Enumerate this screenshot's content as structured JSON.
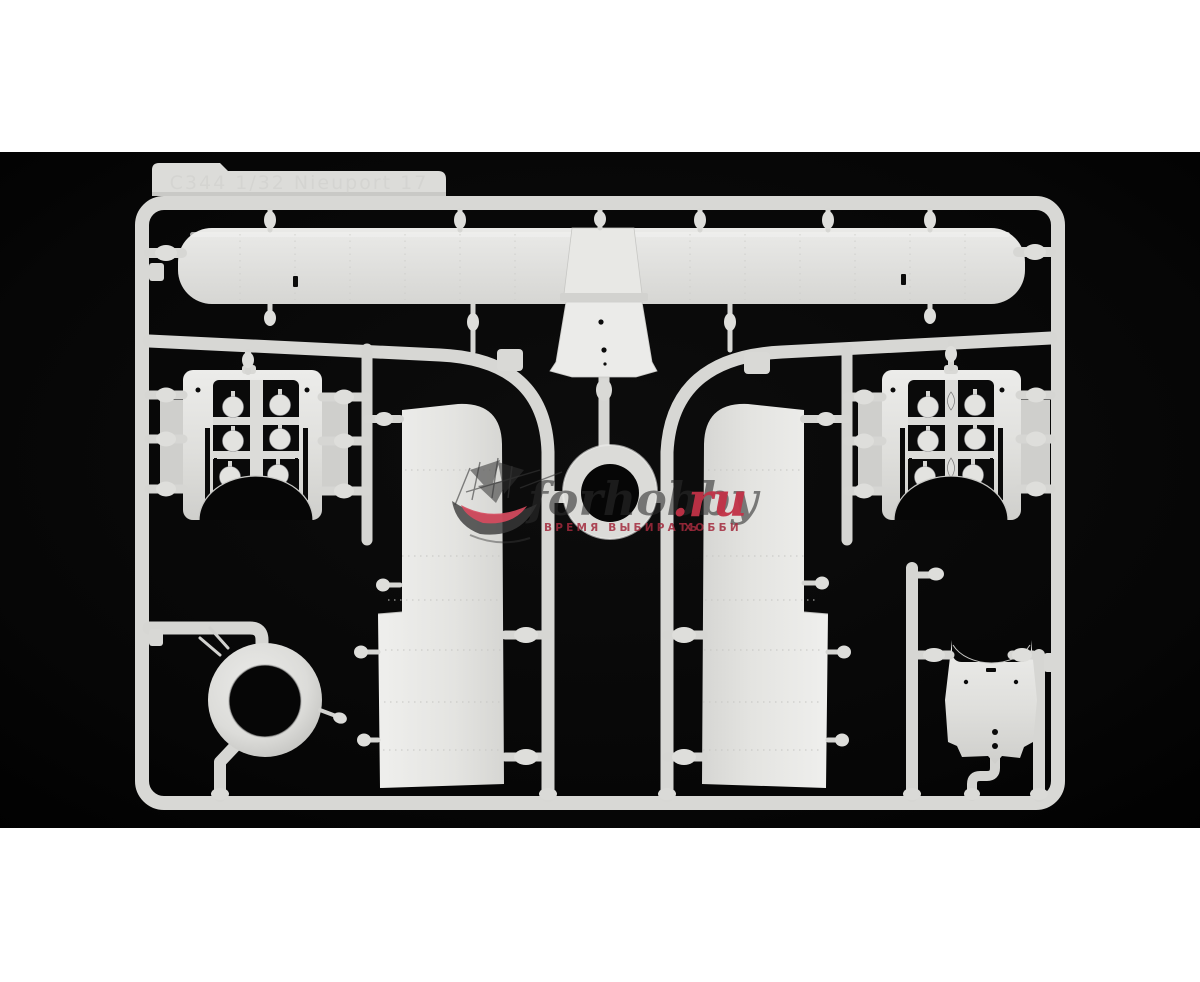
{
  "photo": {
    "type": "product-photo",
    "subject": "injection-molded aircraft model kit sprue in light gray styrene on black background",
    "letterbox_color": "#ffffff",
    "background_color": "#070707",
    "plastic_color": "#d9d9d6",
    "plastic_shadow_color": "#b9b9b6",
    "sprue_label_text": "C344  1/32  Nieuport 17",
    "watermark": {
      "site_script": "forhobby",
      "site_tld": ".ru",
      "tagline_left": "ВРЕМЯ ВЫБИРАТЬ",
      "tagline_right": "ХОББИ",
      "script_color": "#2b2b2b",
      "accent_red": "#c23247",
      "logo": "sailing-ship-icon"
    },
    "parts": [
      "sprue-frame",
      "label-tab",
      "upper-wing",
      "wing-center-section",
      "fuselage-decking",
      "cowl-front-ring-small",
      "fuselage-panel-left",
      "fuselage-panel-right",
      "engine-cowling-panel-left",
      "engine-cowling-panel-right",
      "engine-cowl-ring",
      "cowling-side-panel",
      "runner-arcs",
      "sprue-gates-and-pins"
    ]
  }
}
